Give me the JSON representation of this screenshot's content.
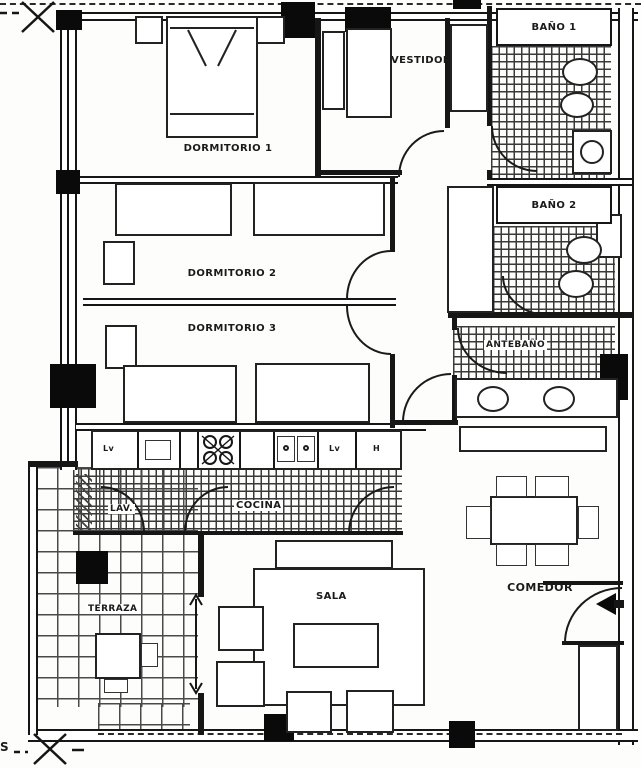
{
  "colors": {
    "line": "#161616",
    "background": "#ffffff"
  },
  "rooms": {
    "dormitorio1": "DORMITORIO 1",
    "dormitorio2": "DORMITORIO 2",
    "dormitorio3": "DORMITORIO 3",
    "vestidor": "VESTIDOR",
    "bano1": "BAÑO 1",
    "bano2": "BAÑO 2",
    "antebano": "ANTEBAÑO",
    "lavadero": "LAV.",
    "cocina": "COCINA",
    "terraza": "TERRAZA",
    "sala": "SALA",
    "comedor": "COMEDOR"
  },
  "kitchen_labels": {
    "cabinet_left": "Lv",
    "cabinet_right": "Lv",
    "fridge": "H"
  },
  "markers": {
    "south": "S"
  }
}
